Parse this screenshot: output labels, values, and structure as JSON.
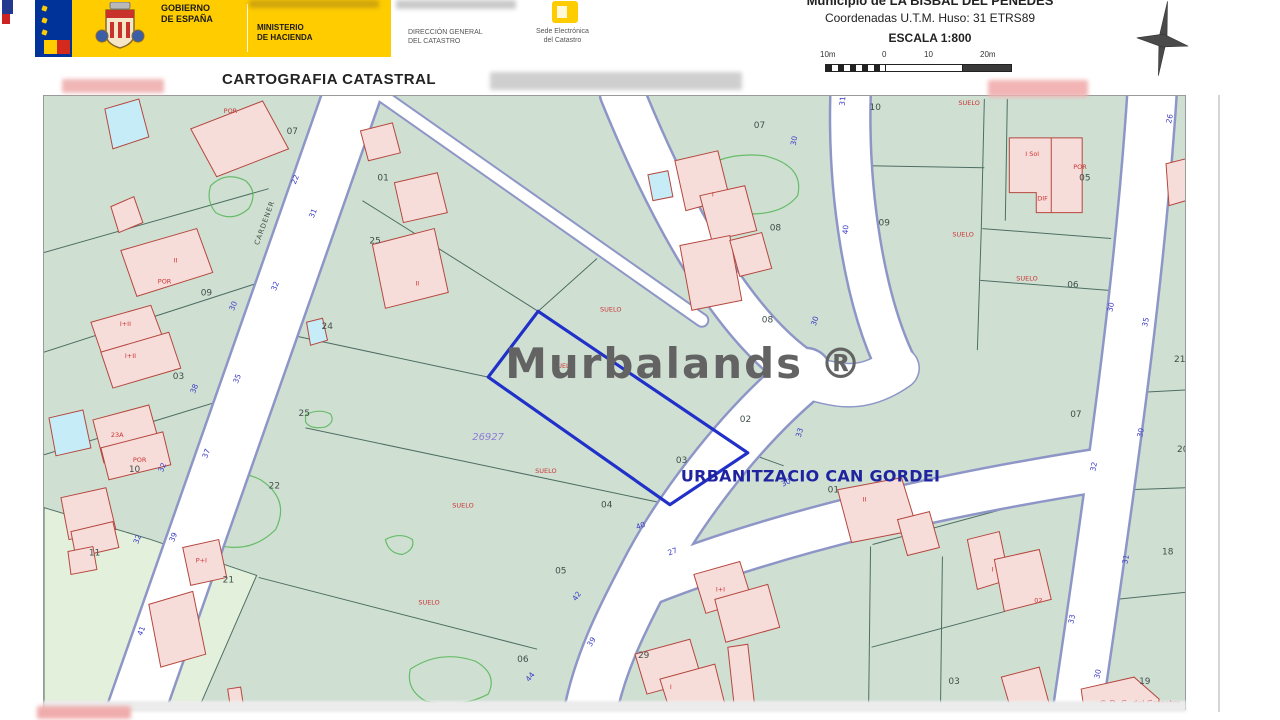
{
  "header": {
    "gobierno": {
      "line1": "GOBIERNO",
      "line2": "DE ESPAÑA"
    },
    "ministerio": {
      "line1": "MINISTERIO",
      "line2": "DE HACIENDA"
    },
    "direccion": {
      "line1": "DIRECCIÓN GENERAL",
      "line2": "DEL CATASTRO"
    },
    "sede": {
      "line1": "Sede Electrónica",
      "line2": "del Catastro"
    },
    "doc_title": "CARTOGRAFIA CATASTRAL",
    "municipality": "Municipio de LA BISBAL DEL PENEDES",
    "coordinates": "Coordenadas U.T.M. Huso: 31 ETRS89",
    "scale": "ESCALA 1:800",
    "scalebar_labels": [
      "10m",
      "0",
      "10",
      "20m"
    ]
  },
  "map": {
    "watermark": "Murbalands ®",
    "urbanization_label": "URBANITZACIO CAN GORDEI",
    "street_name": "CARDENER",
    "reference_number": "26927",
    "copyright": "© D. G. del Catastro",
    "parcel_numbers": [
      {
        "t": "07",
        "x": 286,
        "y": 133
      },
      {
        "t": "01",
        "x": 377,
        "y": 180
      },
      {
        "t": "09",
        "x": 200,
        "y": 295
      },
      {
        "t": "25",
        "x": 369,
        "y": 243
      },
      {
        "t": "24",
        "x": 321,
        "y": 329
      },
      {
        "t": "03",
        "x": 172,
        "y": 379
      },
      {
        "t": "25",
        "x": 298,
        "y": 416
      },
      {
        "t": "10",
        "x": 128,
        "y": 472
      },
      {
        "t": "22",
        "x": 268,
        "y": 489
      },
      {
        "t": "11",
        "x": 88,
        "y": 556
      },
      {
        "t": "21",
        "x": 222,
        "y": 583
      },
      {
        "t": "07",
        "x": 754,
        "y": 127
      },
      {
        "t": "08",
        "x": 770,
        "y": 230
      },
      {
        "t": "08",
        "x": 762,
        "y": 322
      },
      {
        "t": "02",
        "x": 740,
        "y": 422
      },
      {
        "t": "03",
        "x": 676,
        "y": 463
      },
      {
        "t": "04",
        "x": 601,
        "y": 508
      },
      {
        "t": "05",
        "x": 555,
        "y": 574
      },
      {
        "t": "06",
        "x": 517,
        "y": 663
      },
      {
        "t": "29",
        "x": 638,
        "y": 659
      },
      {
        "t": "10",
        "x": 870,
        "y": 109
      },
      {
        "t": "09",
        "x": 879,
        "y": 225
      },
      {
        "t": "05",
        "x": 1080,
        "y": 180
      },
      {
        "t": "06",
        "x": 1068,
        "y": 287
      },
      {
        "t": "07",
        "x": 1071,
        "y": 417
      },
      {
        "t": "21",
        "x": 1175,
        "y": 362
      },
      {
        "t": "20",
        "x": 1178,
        "y": 452
      },
      {
        "t": "18",
        "x": 1163,
        "y": 555
      },
      {
        "t": "19",
        "x": 1140,
        "y": 685
      },
      {
        "t": "01",
        "x": 828,
        "y": 493
      },
      {
        "t": "03",
        "x": 949,
        "y": 685
      }
    ],
    "street_numbers": [
      {
        "t": "22",
        "x": 295,
        "y": 184,
        "r": -68
      },
      {
        "t": "31",
        "x": 313,
        "y": 218,
        "r": -68
      },
      {
        "t": "32",
        "x": 275,
        "y": 291,
        "r": -68
      },
      {
        "t": "30",
        "x": 233,
        "y": 311,
        "r": -68
      },
      {
        "t": "35",
        "x": 237,
        "y": 384,
        "r": -68
      },
      {
        "t": "38",
        "x": 194,
        "y": 394,
        "r": -68
      },
      {
        "t": "37",
        "x": 206,
        "y": 459,
        "r": -68
      },
      {
        "t": "32",
        "x": 162,
        "y": 473,
        "r": -68
      },
      {
        "t": "39",
        "x": 173,
        "y": 543,
        "r": -68
      },
      {
        "t": "32",
        "x": 137,
        "y": 545,
        "r": -68
      },
      {
        "t": "41",
        "x": 141,
        "y": 637,
        "r": -68
      },
      {
        "t": "42",
        "x": 576,
        "y": 602,
        "r": -55
      },
      {
        "t": "39",
        "x": 591,
        "y": 648,
        "r": -58
      },
      {
        "t": "44",
        "x": 529,
        "y": 683,
        "r": -52
      },
      {
        "t": "40",
        "x": 637,
        "y": 530,
        "r": -20
      },
      {
        "t": "27",
        "x": 669,
        "y": 556,
        "r": -20
      },
      {
        "t": "30",
        "x": 783,
        "y": 487,
        "r": -25
      },
      {
        "t": "33",
        "x": 801,
        "y": 438,
        "r": -75
      },
      {
        "t": "30",
        "x": 816,
        "y": 326,
        "r": -72
      },
      {
        "t": "31",
        "x": 845,
        "y": 105,
        "r": -85
      },
      {
        "t": "30",
        "x": 796,
        "y": 145,
        "r": -80
      },
      {
        "t": "40",
        "x": 848,
        "y": 234,
        "r": -85
      },
      {
        "t": "30",
        "x": 1113,
        "y": 312,
        "r": -78
      },
      {
        "t": "35",
        "x": 1148,
        "y": 327,
        "r": -78
      },
      {
        "t": "30",
        "x": 1143,
        "y": 438,
        "r": -78
      },
      {
        "t": "32",
        "x": 1096,
        "y": 472,
        "r": -78
      },
      {
        "t": "31",
        "x": 1128,
        "y": 565,
        "r": -78
      },
      {
        "t": "33",
        "x": 1074,
        "y": 625,
        "r": -78
      },
      {
        "t": "30",
        "x": 1100,
        "y": 680,
        "r": -78
      },
      {
        "t": "26",
        "x": 1172,
        "y": 123,
        "r": -78
      }
    ],
    "red_labels": [
      {
        "t": "SUELO",
        "x": 959,
        "y": 104
      },
      {
        "t": "SUELO",
        "x": 953,
        "y": 236
      },
      {
        "t": "SUELO",
        "x": 1017,
        "y": 280
      },
      {
        "t": "SUELO",
        "x": 600,
        "y": 311
      },
      {
        "t": "SUELO",
        "x": 553,
        "y": 368
      },
      {
        "t": "SUELO",
        "x": 535,
        "y": 473
      },
      {
        "t": "SUELO",
        "x": 452,
        "y": 508
      },
      {
        "t": "SUELO",
        "x": 418,
        "y": 605
      },
      {
        "t": "POR",
        "x": 223,
        "y": 112
      },
      {
        "t": "POR",
        "x": 157,
        "y": 283
      },
      {
        "t": "II",
        "x": 173,
        "y": 262
      },
      {
        "t": "I+II",
        "x": 119,
        "y": 326
      },
      {
        "t": "I+II",
        "x": 124,
        "y": 358
      },
      {
        "t": "23A",
        "x": 110,
        "y": 437
      },
      {
        "t": "POR",
        "x": 132,
        "y": 462
      },
      {
        "t": "P+I",
        "x": 195,
        "y": 563
      },
      {
        "t": "II",
        "x": 415,
        "y": 285
      },
      {
        "t": "I",
        "x": 712,
        "y": 196
      },
      {
        "t": "I Sol",
        "x": 1026,
        "y": 155
      },
      {
        "t": "POR",
        "x": 1074,
        "y": 168
      },
      {
        "t": "DIF",
        "x": 1038,
        "y": 200
      },
      {
        "t": "02",
        "x": 1035,
        "y": 603
      },
      {
        "t": "I+I",
        "x": 716,
        "y": 592
      },
      {
        "t": "II",
        "x": 863,
        "y": 502
      },
      {
        "t": "I",
        "x": 992,
        "y": 572
      },
      {
        "t": "I",
        "x": 670,
        "y": 690
      }
    ]
  },
  "colors": {
    "gov_yellow": "#ffcc00",
    "flag_blue": "#003399",
    "map_background": "#cfe0d3",
    "road_edge": "#8d96c6",
    "parcel_boundary": "#4f6e63",
    "building_fill": "#f7ddda",
    "building_stroke": "#b5473e",
    "pool_fill": "#c6edf7",
    "vegetation": "#5cb85c",
    "highlight_parcel_blue": "#2030c8",
    "street_number_blue": "#3a3ac6",
    "label_red": "#cc3434",
    "urbanization_blue": "#1f23a0",
    "watermark_gray": "#636363"
  }
}
